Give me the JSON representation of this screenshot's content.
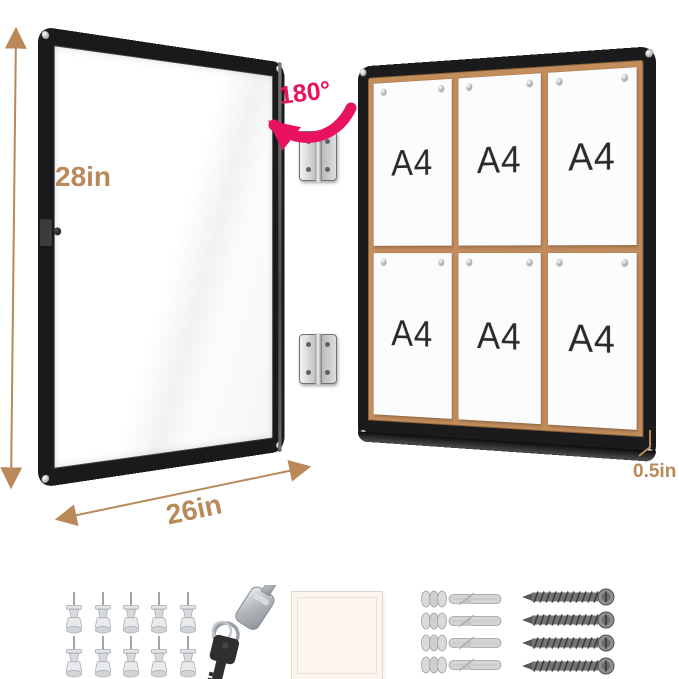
{
  "annotations": {
    "height": "28in",
    "width": "26in",
    "depth": "0.5in",
    "swing_angle": "180°",
    "dimension_color": "#b9895a",
    "angle_color": "#e8125f"
  },
  "board": {
    "frame_color": "#1b1b1d",
    "cork_color": "#c38d5c",
    "pins_per_paper": 2,
    "papers": [
      {
        "label": "A4"
      },
      {
        "label": "A4"
      },
      {
        "label": "A4"
      },
      {
        "label": "A4"
      },
      {
        "label": "A4"
      },
      {
        "label": "A4"
      }
    ]
  },
  "door": {
    "frame_color": "#1a1a1c",
    "hinge_count": 2,
    "has_lock": true
  },
  "accessories": {
    "push_pins_count": 10,
    "keys_count": 2,
    "backing_sheet_count": 1,
    "wall_anchors_count": 4,
    "screws_count": 4
  }
}
